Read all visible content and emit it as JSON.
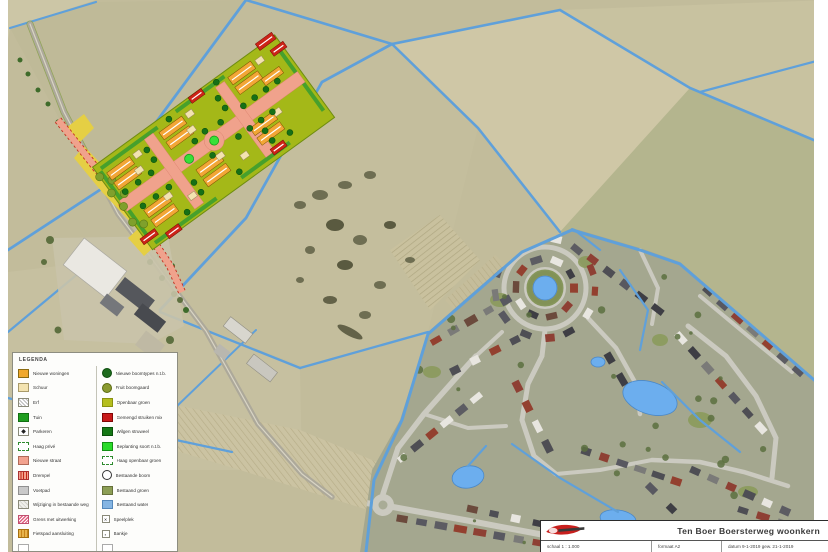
{
  "legend": {
    "title": "LEGENDA",
    "left_items": [
      {
        "label": "Nieuwe woningen",
        "swatch": "new-dwellings"
      },
      {
        "label": "Schuur",
        "swatch": "shed"
      },
      {
        "label": "Erf",
        "swatch": "yard"
      },
      {
        "label": "Tuin",
        "swatch": "garden"
      },
      {
        "label": "Parkeren",
        "swatch": "parking"
      },
      {
        "label": "Haag privé",
        "swatch": "hedge-private"
      },
      {
        "label": "Nieuwe straat",
        "swatch": "new-street"
      },
      {
        "label": "Drempel",
        "swatch": "speed-bump"
      },
      {
        "label": "Voetpad",
        "swatch": "footpath"
      },
      {
        "label": "Wijziging in bestaande weg",
        "swatch": "road-change"
      },
      {
        "label": "Grens met uitwerking",
        "swatch": "boundary"
      },
      {
        "label": "Fietspad aansluiting",
        "swatch": "bike-path"
      },
      {
        "label": "",
        "swatch": "empty"
      }
    ],
    "right_items": [
      {
        "label": "Nieuwe boomtypes n.t.b.",
        "swatch": "new-trees"
      },
      {
        "label": "Fruit boomgaard",
        "swatch": "orchard"
      },
      {
        "label": "Openbaar groen",
        "swatch": "public-green"
      },
      {
        "label": "Gemengd struiken mix",
        "swatch": "shrub-mix"
      },
      {
        "label": "Wilgen struweel",
        "swatch": "willow-scrub"
      },
      {
        "label": "Beplanting soort n.t.b.",
        "swatch": "planting-tbd"
      },
      {
        "label": "Haag openbaar groen",
        "swatch": "hedge-public"
      },
      {
        "label": "Bestaande boom",
        "swatch": "existing-tree"
      },
      {
        "label": "Bestaand groen",
        "swatch": "existing-green"
      },
      {
        "label": "Bestaand water",
        "swatch": "existing-water"
      },
      {
        "label": "Speelplek",
        "swatch": "playground"
      },
      {
        "label": "Bankje",
        "swatch": "bench"
      },
      {
        "label": "",
        "swatch": "empty"
      }
    ]
  },
  "title_block": {
    "project_title": "Ten Boer  Boersterweg woonkern",
    "scale": "schaal 1 : 1.000",
    "format": "formaat A2",
    "date": "datum 9-1-2019   gew. 21-1-2019"
  },
  "colors": {
    "new_dwellings": "#F2A636",
    "shed": "#F3E3B0",
    "garden": "#1F9E1F",
    "new_street": "#F0A28C",
    "public_green": "#A4B818",
    "red_building": "#CC2418",
    "planting_bright": "#38E038",
    "dark_tree": "#167016",
    "existing_green": "#8C9E55",
    "water": "#6CAEEE",
    "field": "#C2BC9B",
    "village_base": "#A4A78F",
    "road": "#ADA99A",
    "yellow_verge": "#E5CF44"
  }
}
